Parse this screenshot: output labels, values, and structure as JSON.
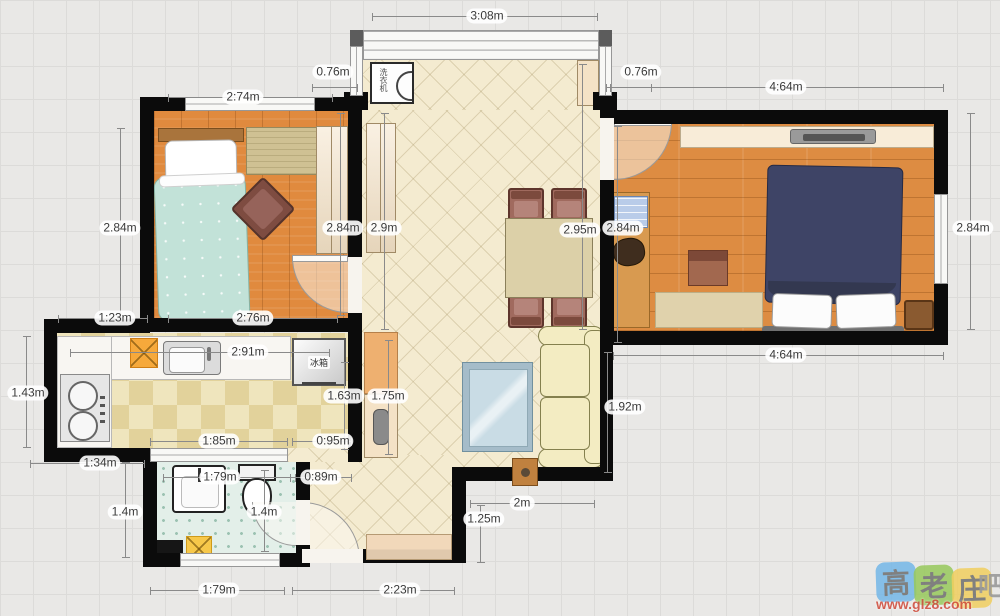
{
  "plan": {
    "appliances": {
      "washing_machine": "洗衣机",
      "fridge": "冰箱"
    }
  },
  "dimensions": [
    {
      "text": "3:08m",
      "label": [
        487,
        16
      ],
      "line": {
        "o": "h",
        "x": 372,
        "y": 16,
        "len": 226
      }
    },
    {
      "text": "0.76m",
      "label": [
        333,
        72
      ],
      "line": {
        "o": "h",
        "x": 312,
        "y": 87,
        "len": 46
      }
    },
    {
      "text": "0.76m",
      "label": [
        641,
        72
      ],
      "line": {
        "o": "h",
        "x": 606,
        "y": 87,
        "len": 46
      }
    },
    {
      "text": "2:74m",
      "label": [
        243,
        97
      ],
      "line": {
        "o": "h",
        "x": 168,
        "y": 97,
        "len": 165
      }
    },
    {
      "text": "4:64m",
      "label": [
        786,
        87
      ],
      "line": {
        "o": "h",
        "x": 610,
        "y": 87,
        "len": 334
      }
    },
    {
      "text": "2.84m",
      "label": [
        120,
        228
      ],
      "line": {
        "o": "v",
        "x": 120,
        "y": 128,
        "len": 190
      }
    },
    {
      "text": "2.84m",
      "label": [
        343,
        228
      ],
      "line": {
        "o": "v",
        "x": 340,
        "y": 113,
        "len": 203
      }
    },
    {
      "text": "2.9m",
      "label": [
        384,
        228
      ],
      "line": {
        "o": "v",
        "x": 384,
        "y": 113,
        "len": 217
      }
    },
    {
      "text": "2.95m",
      "label": [
        580,
        230
      ],
      "line": {
        "o": "v",
        "x": 582,
        "y": 64,
        "len": 266
      }
    },
    {
      "text": "2.84m",
      "label": [
        623,
        228
      ],
      "line": {
        "o": "v",
        "x": 617,
        "y": 126,
        "len": 217
      }
    },
    {
      "text": "2.84m",
      "label": [
        973,
        228
      ],
      "line": {
        "o": "v",
        "x": 970,
        "y": 113,
        "len": 217
      }
    },
    {
      "text": "2:76m",
      "label": [
        253,
        318
      ],
      "line": {
        "o": "h",
        "x": 168,
        "y": 318,
        "len": 170
      }
    },
    {
      "text": "1:23m",
      "label": [
        115,
        318
      ],
      "line": {
        "o": "h",
        "x": 58,
        "y": 318,
        "len": 90
      }
    },
    {
      "text": "2:91m",
      "label": [
        248,
        352
      ],
      "line": {
        "o": "h",
        "x": 70,
        "y": 352,
        "len": 260
      }
    },
    {
      "text": "4:64m",
      "label": [
        786,
        355
      ],
      "line": {
        "o": "h",
        "x": 613,
        "y": 355,
        "len": 331
      }
    },
    {
      "text": "1.43m",
      "label": [
        28,
        393
      ],
      "line": {
        "o": "v",
        "x": 26,
        "y": 336,
        "len": 112
      }
    },
    {
      "text": "1.63m",
      "label": [
        344,
        396
      ],
      "line": {
        "o": "v",
        "x": 344,
        "y": 362,
        "len": 88
      }
    },
    {
      "text": "1.75m",
      "label": [
        388,
        396
      ],
      "line": {
        "o": "v",
        "x": 388,
        "y": 340,
        "len": 115
      }
    },
    {
      "text": "1.92m",
      "label": [
        625,
        407
      ],
      "line": {
        "o": "v",
        "x": 607,
        "y": 352,
        "len": 121
      }
    },
    {
      "text": "1:85m",
      "label": [
        219,
        441
      ],
      "line": {
        "o": "h",
        "x": 150,
        "y": 441,
        "len": 138
      }
    },
    {
      "text": "0:95m",
      "label": [
        333,
        441
      ],
      "line": {
        "o": "h",
        "x": 292,
        "y": 441,
        "len": 60
      }
    },
    {
      "text": "1:34m",
      "label": [
        100,
        463
      ],
      "line": {
        "o": "h",
        "x": 30,
        "y": 463,
        "len": 115
      }
    },
    {
      "text": "1:79m",
      "label": [
        220,
        477
      ],
      "line": {
        "o": "h",
        "x": 163,
        "y": 477,
        "len": 133
      }
    },
    {
      "text": "0:89m",
      "label": [
        321,
        477
      ],
      "line": {
        "o": "h",
        "x": 290,
        "y": 477,
        "len": 62
      }
    },
    {
      "text": "1.4m",
      "label": [
        125,
        512
      ],
      "line": {
        "o": "v",
        "x": 125,
        "y": 462,
        "len": 96
      }
    },
    {
      "text": "1.4m",
      "label": [
        264,
        512
      ],
      "line": {
        "o": "v",
        "x": 264,
        "y": 470,
        "len": 82
      }
    },
    {
      "text": "2m",
      "label": [
        522,
        503
      ],
      "line": {
        "o": "h",
        "x": 470,
        "y": 503,
        "len": 125
      }
    },
    {
      "text": "1.25m",
      "label": [
        484,
        519
      ],
      "line": {
        "o": "v",
        "x": 480,
        "y": 505,
        "len": 58
      }
    },
    {
      "text": "1:79m",
      "label": [
        219,
        590
      ],
      "line": {
        "o": "h",
        "x": 150,
        "y": 590,
        "len": 135
      }
    },
    {
      "text": "2:23m",
      "label": [
        400,
        590
      ],
      "line": {
        "o": "h",
        "x": 292,
        "y": 590,
        "len": 163
      }
    }
  ],
  "watermark": {
    "tiles": [
      {
        "char": "高",
        "color": "#74b7e8"
      },
      {
        "char": "老",
        "color": "#97c95c"
      },
      {
        "char": "庄",
        "color": "#f1cf5f"
      }
    ],
    "suffix": "吧",
    "url": "www.glz8.com"
  }
}
